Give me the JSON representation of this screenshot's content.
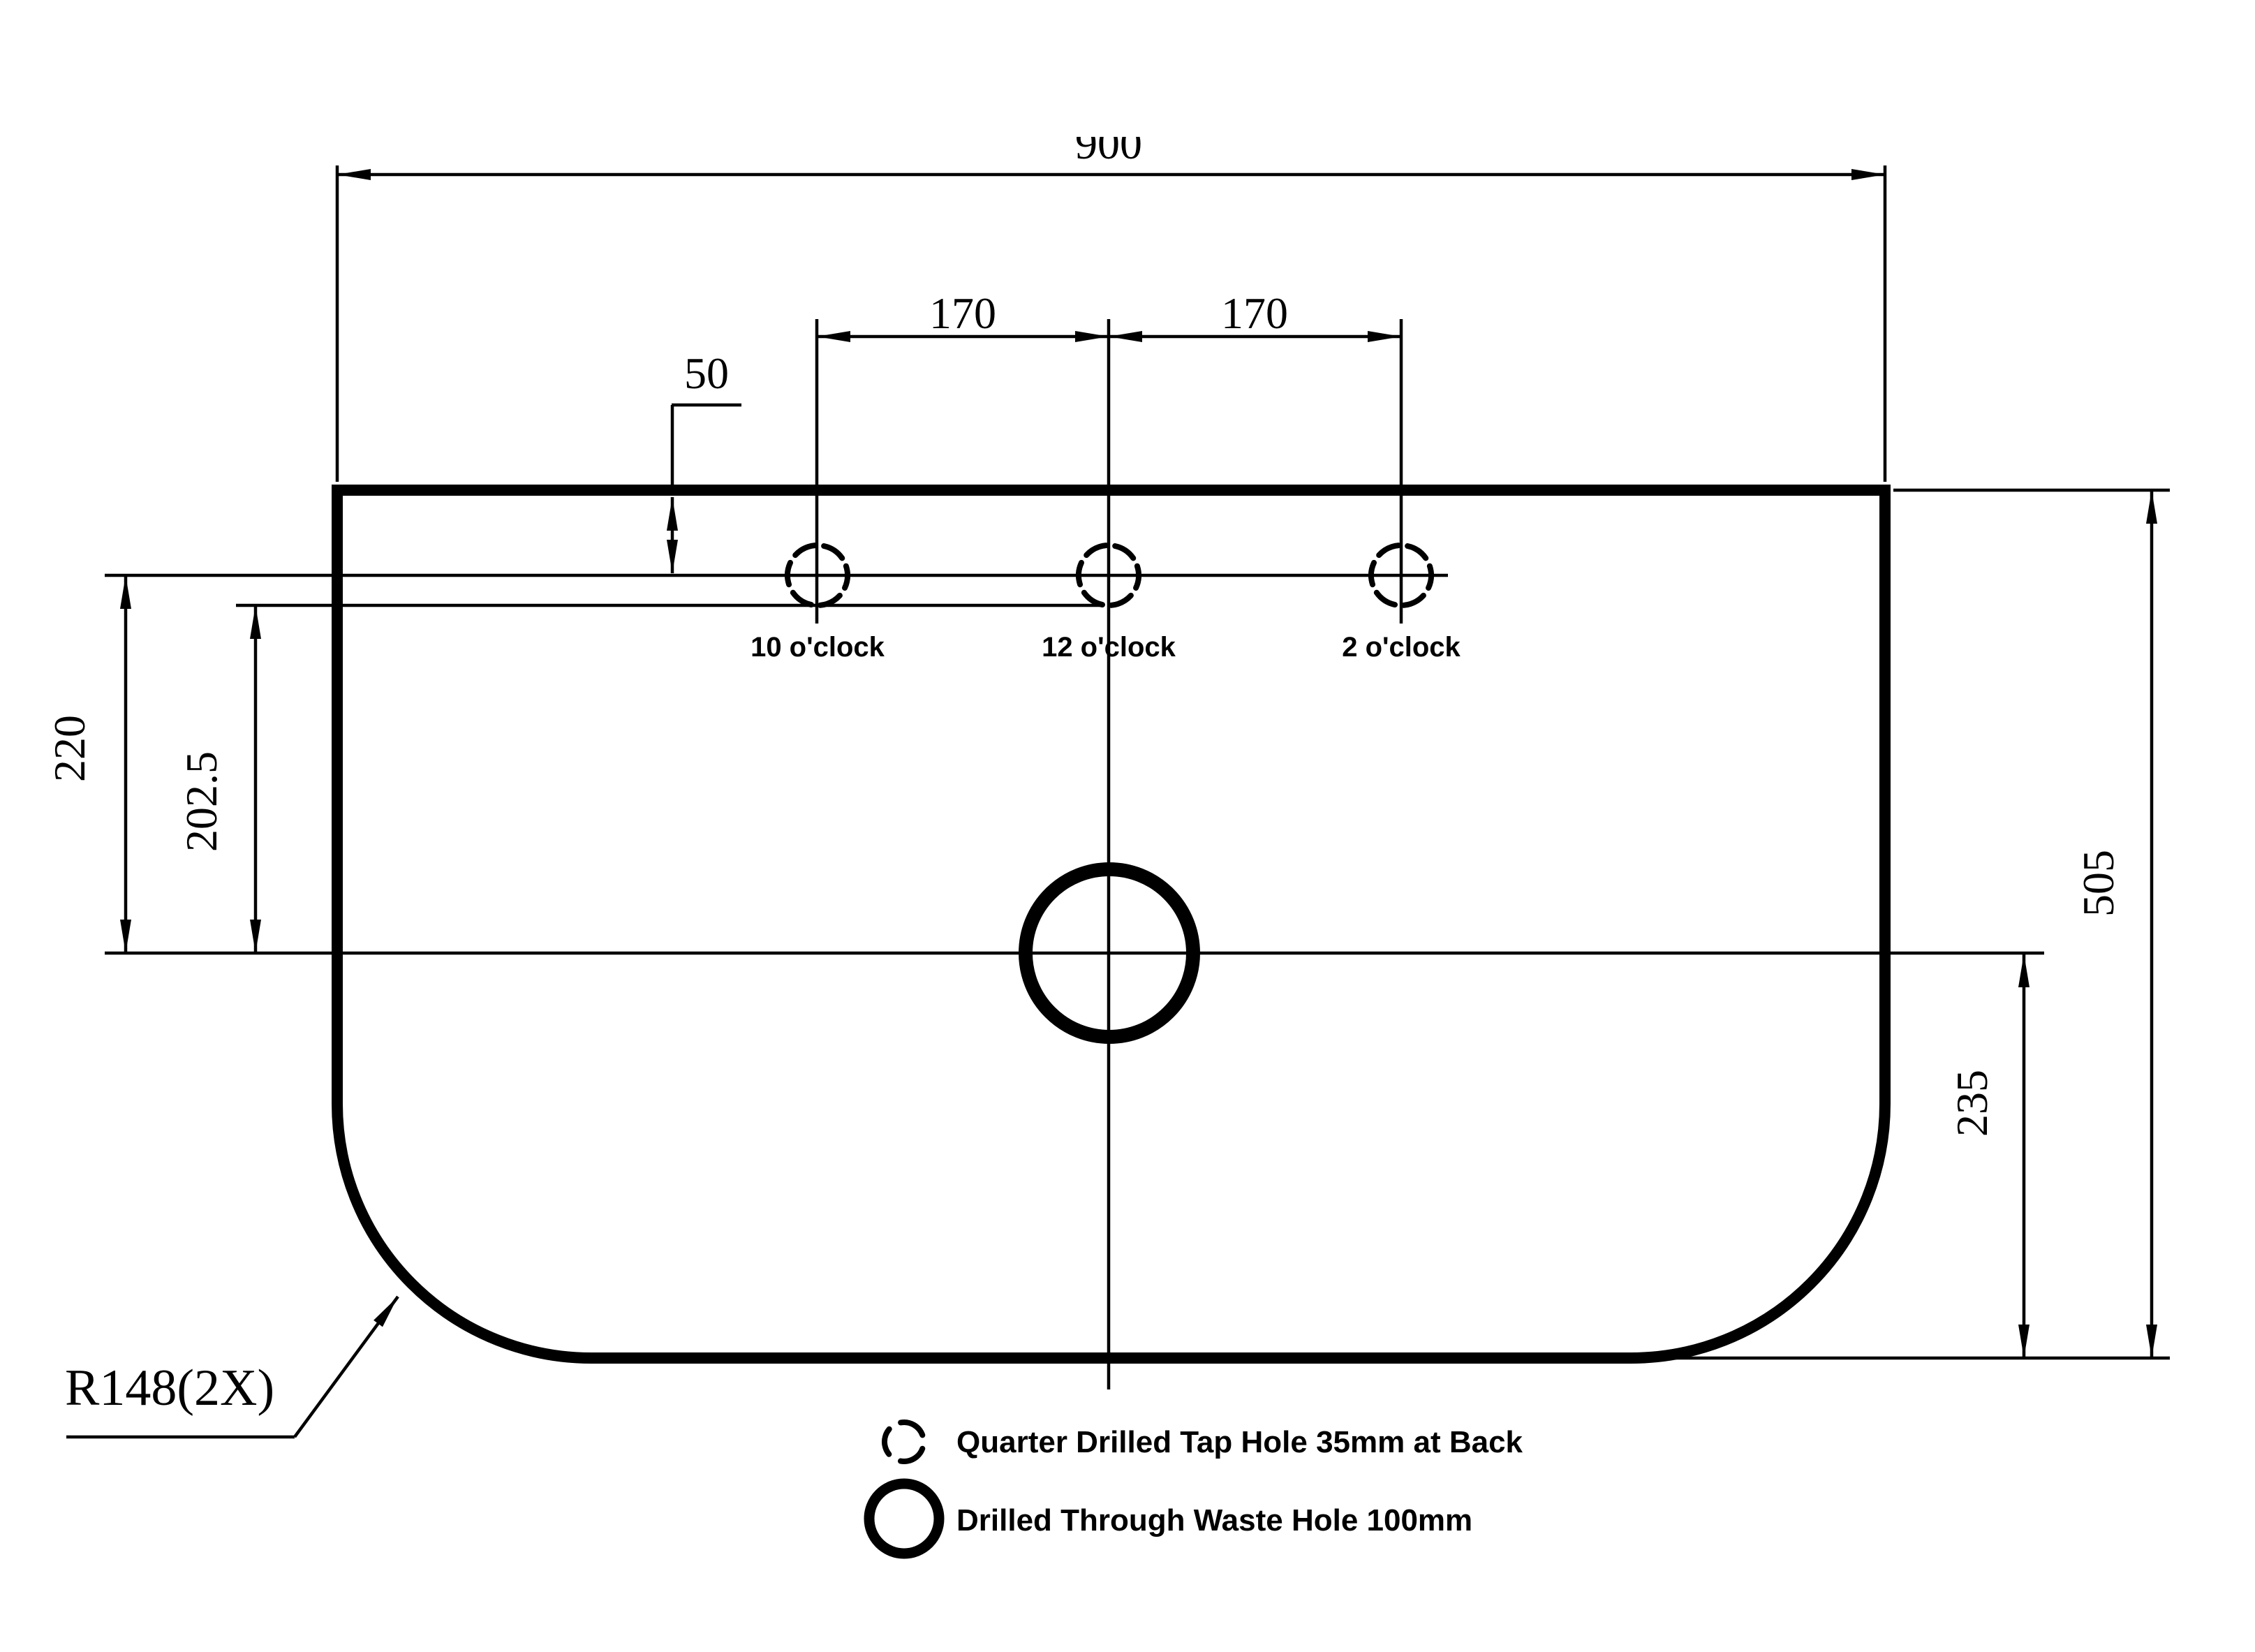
{
  "drawing": {
    "line_color": "#000000",
    "background_color": "#ffffff",
    "dimensions": {
      "overall_width": "900",
      "tap_spacing_left": "170",
      "tap_spacing_right": "170",
      "tap_offset_from_back": "50",
      "back_line_to_waste_center": "220",
      "tap_bottom_to_waste_center": "202.5",
      "overall_depth": "505",
      "waste_center_to_front": "235",
      "corner_radius_callout": "R148(2X)"
    },
    "tap_hole_labels": [
      "10 o'clock",
      "12 o'clock",
      "2 o'clock"
    ],
    "legend": [
      {
        "icon": "dashed-circle-icon",
        "label": "Quarter Drilled Tap Hole 35mm at Back"
      },
      {
        "icon": "solid-circle-icon",
        "label": "Drilled Through Waste Hole 100mm"
      }
    ]
  }
}
